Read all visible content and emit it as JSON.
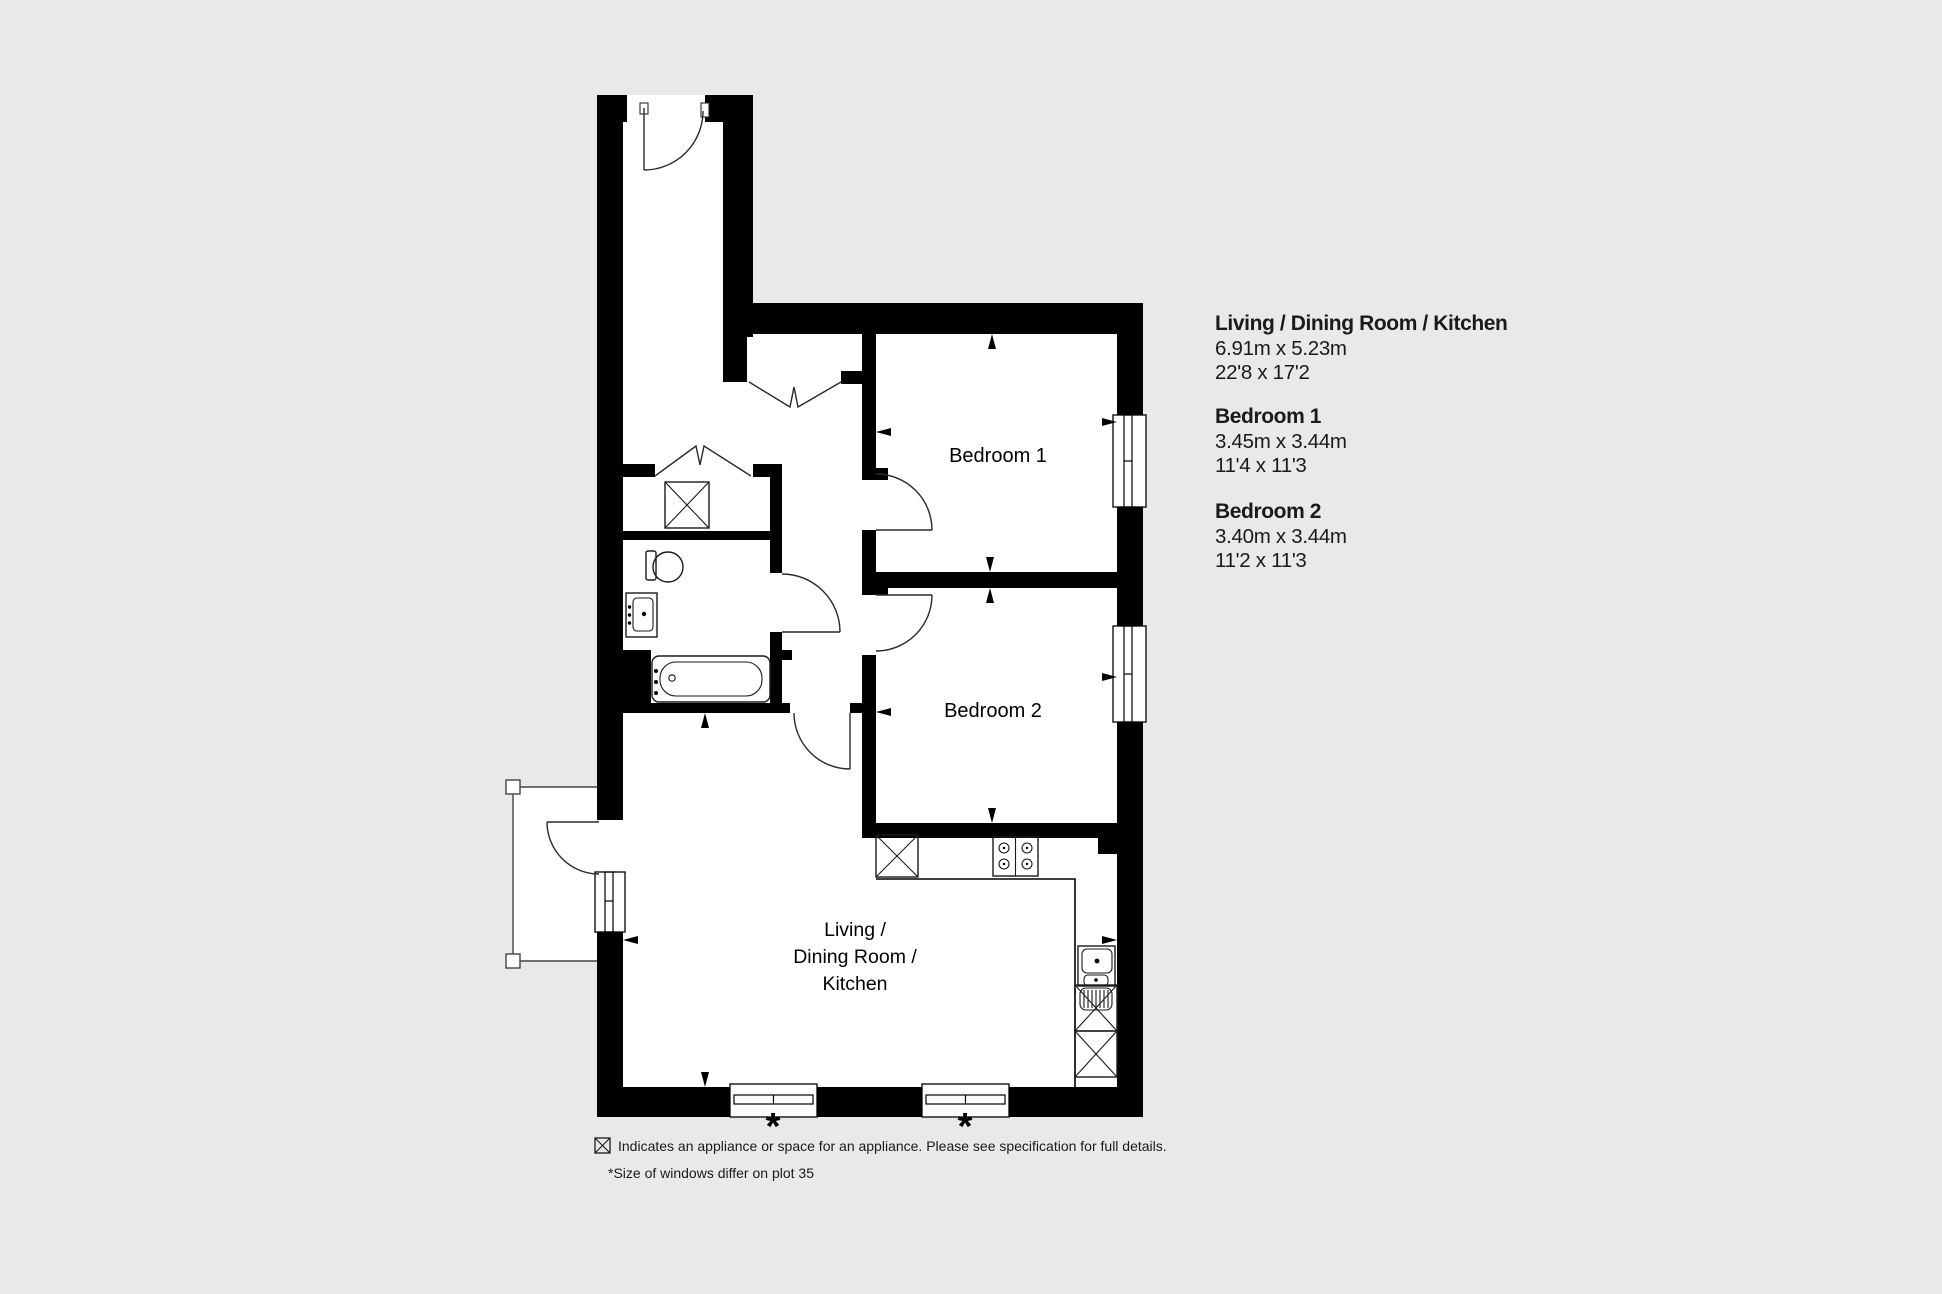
{
  "colors": {
    "background": "#e9e9e9",
    "plan_interior": "#ffffff",
    "walls": "#000000",
    "text": "#1a1a1a"
  },
  "rooms": {
    "bedroom1": {
      "label": "Bedroom 1"
    },
    "bedroom2": {
      "label": "Bedroom 2"
    },
    "living": {
      "line1": "Living  /",
      "line2": "Dining Room /",
      "line3": "Kitchen"
    }
  },
  "dimensions_panel": {
    "sections": [
      {
        "title": "Living / Dining Room / Kitchen",
        "metric": "6.91m x 5.23m",
        "imperial": "22'8 x 17'2"
      },
      {
        "title": "Bedroom 1",
        "metric": "3.45m x 3.44m",
        "imperial": "11'4 x 11'3"
      },
      {
        "title": "Bedroom 2",
        "metric": "3.40m x 3.44m",
        "imperial": "11'2 x 11'3"
      }
    ]
  },
  "legend": {
    "appliance_note": "Indicates an appliance or space for an appliance. Please see specification for full details.",
    "window_note": "*Size of windows differ on plot 35"
  },
  "markers": {
    "window_asterisk": "*"
  }
}
